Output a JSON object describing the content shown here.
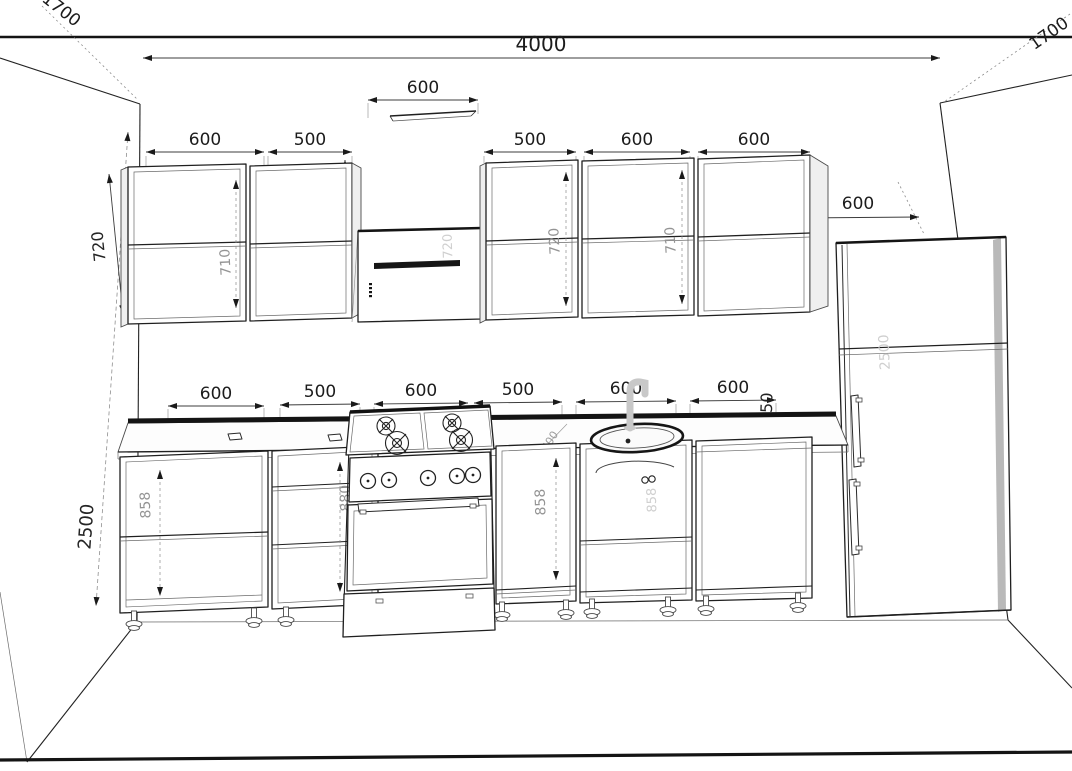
{
  "dimensions": {
    "overall_width": "4000",
    "left_wall_return": "1700",
    "right_wall_return": "1700",
    "wall_height": "2500",
    "hood_width": "600",
    "upper_left": [
      "600",
      "500"
    ],
    "upper_right": [
      "500",
      "600",
      "600"
    ],
    "fridge_width": "600",
    "upper_cabinet_height": "720",
    "upper_to_counter_gap": "950",
    "base": [
      "600",
      "500",
      "600",
      "500",
      "600",
      "600"
    ],
    "counter_height": "850",
    "counter_depth": "600"
  },
  "interior_labels": {
    "upper_left_cab1": "710",
    "hood_height": "720",
    "upper_right_cab1": "720",
    "upper_right_cab2": "710",
    "base_cab1": "858",
    "base_cab2": "880",
    "base_cab4": "858",
    "base_cab5": "858",
    "fridge_height": "2500"
  }
}
